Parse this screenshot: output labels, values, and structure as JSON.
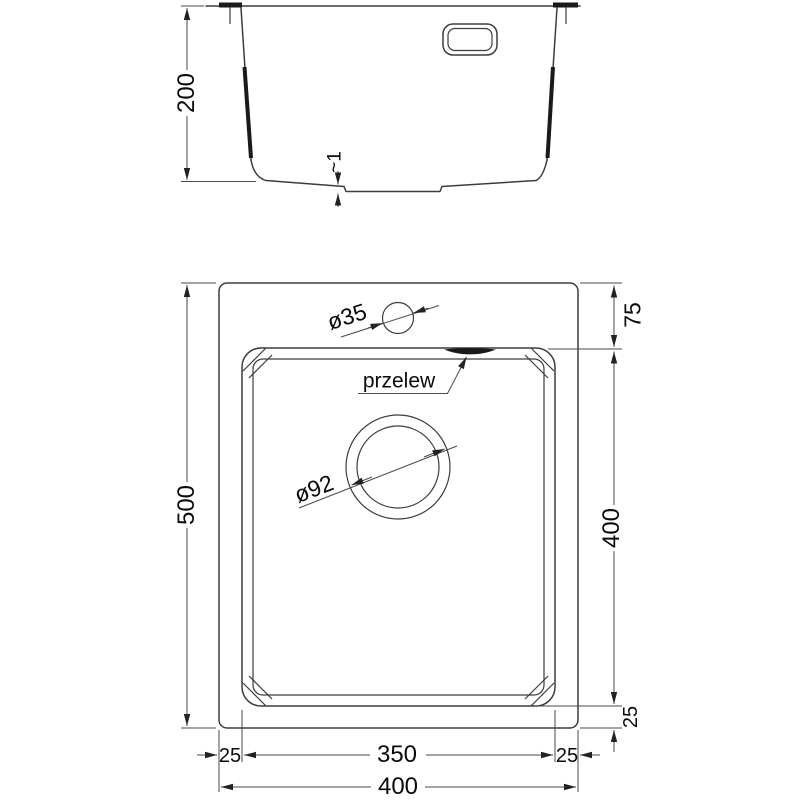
{
  "drawing": {
    "title": "sink-technical-drawing",
    "section_view": {
      "depth_label": "200",
      "bottom_thickness_label": "~1"
    },
    "plan_view": {
      "total_height_label": "500",
      "top_offset_label": "75",
      "bowl_height_label": "400",
      "bowl_bottom_offset_label": "25",
      "faucet_hole_label": "ø35",
      "overflow_label": "przelew",
      "drain_label": "ø92",
      "left_margin_label": "25",
      "bowl_width_label": "350",
      "right_margin_label": "25",
      "total_width_label": "400"
    },
    "colors": {
      "line": "#3d3d3d",
      "dim": "#4a4a4a",
      "text": "#0a0a0a",
      "background": "#ffffff"
    }
  }
}
